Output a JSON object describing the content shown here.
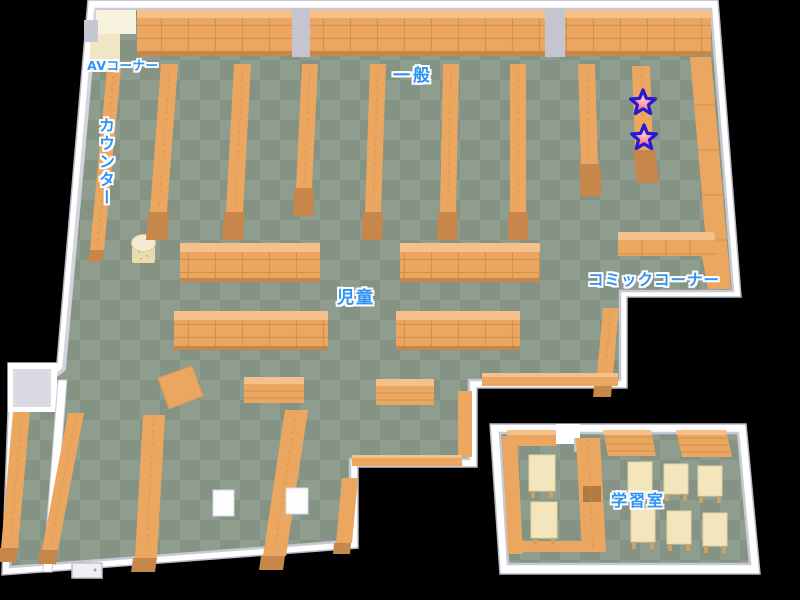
{
  "areas": {
    "av_corner": {
      "label": "AVコーナー"
    },
    "counter": {
      "label": "カウンター"
    },
    "general": {
      "label": "一般"
    },
    "children": {
      "label": "児童"
    },
    "comic_corner": {
      "label": "コミックコーナー"
    },
    "study_room": {
      "label": "学習室"
    }
  },
  "markers": [
    {
      "name": "star-marker-1",
      "icon": "star-icon"
    },
    {
      "name": "star-marker-2",
      "icon": "star-icon"
    }
  ],
  "colors": {
    "floor_light": "#8E9D8D",
    "floor_dark": "#849383",
    "wall": "#FFFFFF",
    "wall_shade": "#D9DAE4",
    "wall_dark": "#C4C5D0",
    "shelf": "#EBA760",
    "shelf_top": "#F5C089",
    "shelf_dark": "#C8874A",
    "desk": "#F4E6BC",
    "desk_leg": "#CBA368",
    "cream": "#F2EBCF",
    "label_blue": "#2E93F5",
    "star_outline": "#2519D6",
    "star_fill": "#F03E5C"
  }
}
